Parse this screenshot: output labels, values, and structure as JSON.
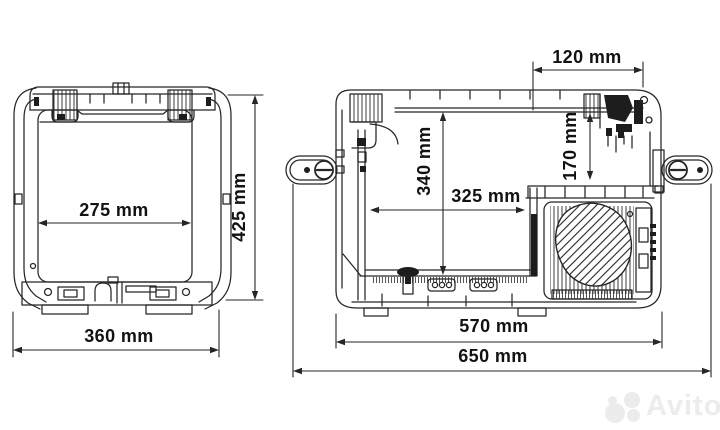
{
  "colors": {
    "background": "#ffffff",
    "line": "#262626",
    "dimension_text": "#121212",
    "watermark": "#ececec"
  },
  "views": {
    "front": {
      "dimensions": [
        {
          "id": "inner-width",
          "label": "275 mm"
        },
        {
          "id": "overall-height",
          "label": "425 mm"
        },
        {
          "id": "overall-width",
          "label": "360 mm"
        }
      ]
    },
    "side": {
      "dimensions": [
        {
          "id": "top-rear-offset",
          "label": "120 mm"
        },
        {
          "id": "interior-height",
          "label": "340 mm"
        },
        {
          "id": "rear-section-height",
          "label": "170 mm"
        },
        {
          "id": "interior-depth",
          "label": "325 mm"
        },
        {
          "id": "body-depth",
          "label": "570 mm"
        },
        {
          "id": "overall-depth",
          "label": "650 mm"
        }
      ]
    }
  },
  "watermark": {
    "text": "Avito"
  }
}
